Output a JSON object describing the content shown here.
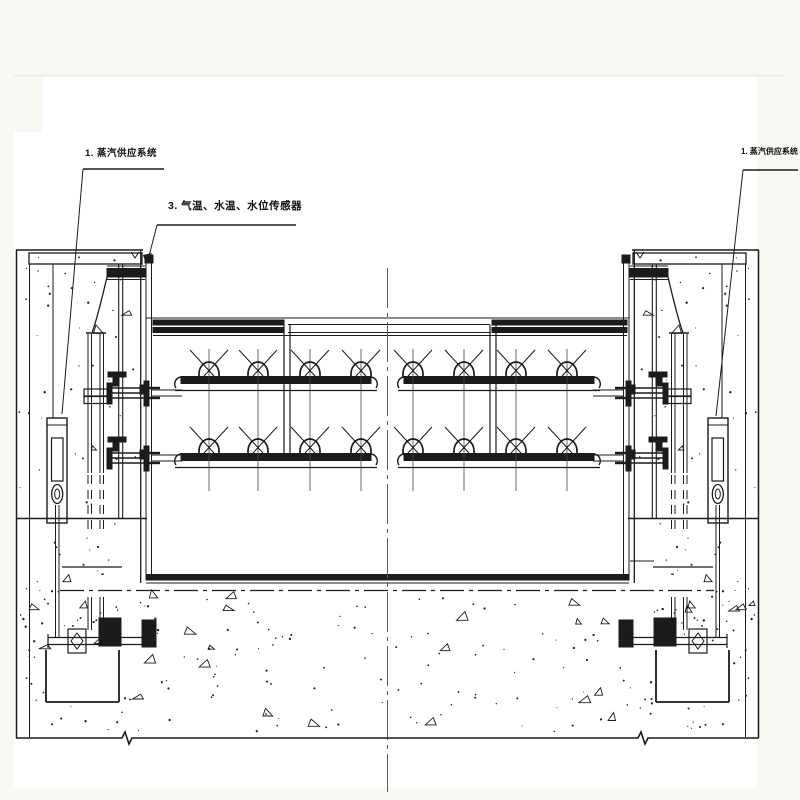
{
  "labels": {
    "steam_supply_left": {
      "text": "1. 蒸汽供应系统"
    },
    "sensors": {
      "text": "3. 气温、水温、水位传感器"
    },
    "steam_supply_right": {
      "text": "1. 蒸汽供应系统"
    }
  },
  "colors": {
    "background": "#f7f9f2",
    "paper": "#ffffff",
    "line": "#1b1b1b",
    "centerline": "#5a5a5a"
  }
}
